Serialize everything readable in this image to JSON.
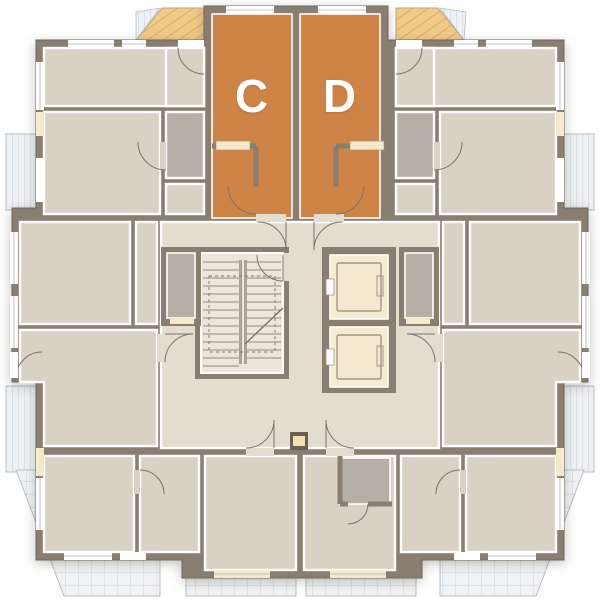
{
  "plan": {
    "units": [
      {
        "id": "C",
        "label": "C",
        "highlighted": true
      },
      {
        "id": "D",
        "label": "D",
        "highlighted": true
      }
    ],
    "core": {
      "stairs": true,
      "elevator_count": 2
    },
    "colors": {
      "highlight": "#CE8347",
      "wall": "#8A7E71",
      "floor": "#D9D1C4",
      "corridor": "#E3DDD0",
      "stair_room": "#ECE6DA",
      "elevator_shaft": "#F6ECD2",
      "wet_room": "#B5AFA6",
      "balcony_glass": "#EDF1F4",
      "balcony_wood": "#EEC377",
      "sill": "#F5E9CB",
      "label_text": "#FFFFFF"
    }
  }
}
